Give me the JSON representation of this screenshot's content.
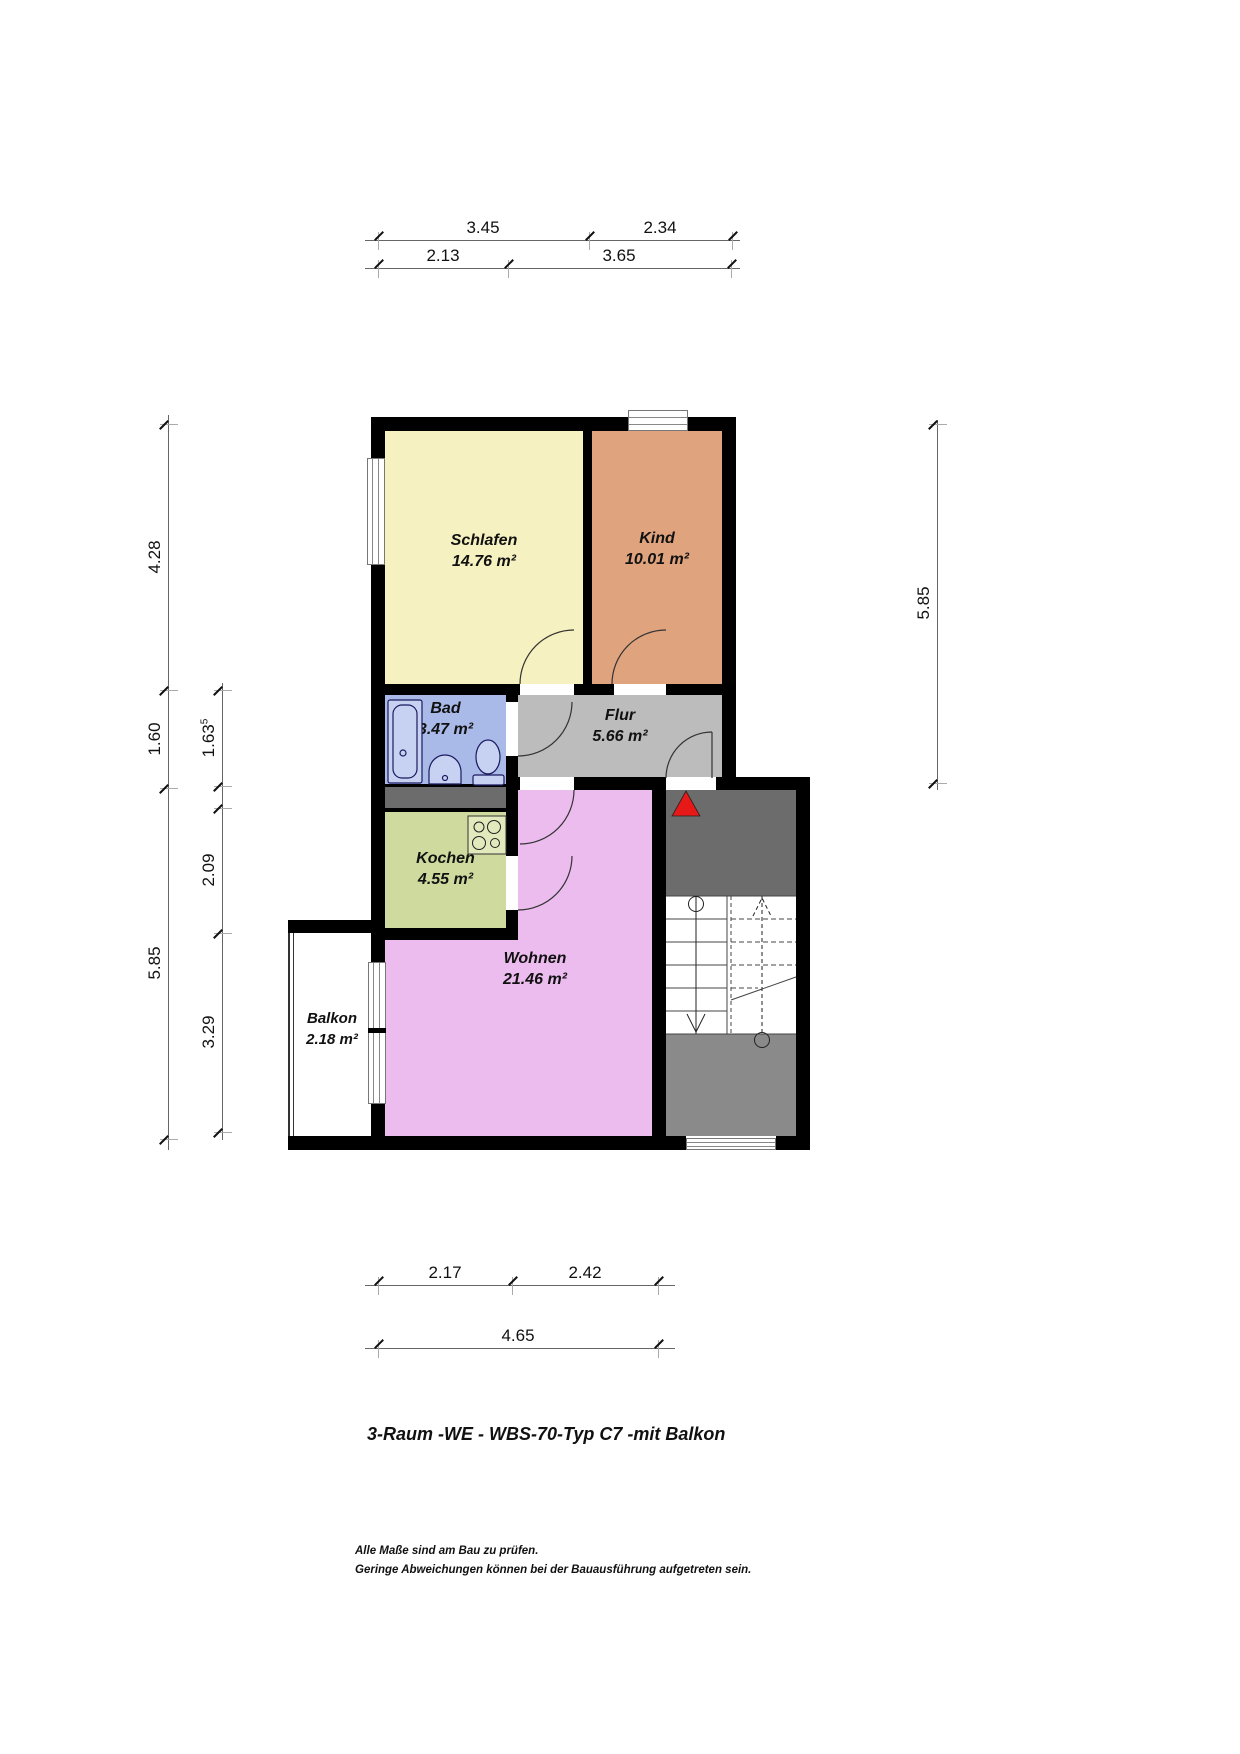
{
  "title": "3-Raum -WE - WBS-70-Typ C7 -mit Balkon",
  "notes": {
    "line1": "Alle Maße sind am Bau zu prüfen.",
    "line2": "Geringe Abweichungen können bei der Bauausführung aufgetreten sein."
  },
  "rooms": [
    {
      "name": "Schlafen",
      "area": "14.76 m²",
      "color": "#f6f1c0"
    },
    {
      "name": "Kind",
      "area": "10.01 m²",
      "color": "#dfa37e"
    },
    {
      "name": "Bad",
      "area": "3.47 m²",
      "color": "#a9b9e8"
    },
    {
      "name": "Flur",
      "area": "5.66 m²",
      "color": "#bcbcbc"
    },
    {
      "name": "Kochen",
      "area": "4.55 m²",
      "color": "#cfda9e"
    },
    {
      "name": "Wohnen",
      "area": "21.46 m²",
      "color": "#ecbcee"
    },
    {
      "name": "Balkon",
      "area": "2.18 m²",
      "color": "#ffffff"
    }
  ],
  "stairwell": {
    "landing_upper_color": "#6c6c6c",
    "landing_lower_color": "#8a8a8a",
    "entry_marker_color": "#e71818"
  },
  "dims": {
    "top1": [
      "3.45",
      "2.34"
    ],
    "top2": [
      "2.13",
      "3.65"
    ],
    "bottom1": [
      "2.17",
      "2.42"
    ],
    "bottom2": [
      "4.65"
    ],
    "left_outer": [
      "4.28",
      "1.60",
      "5.85"
    ],
    "left_inner_top": "1.63",
    "left_inner_top_sup": "5",
    "left_inner": [
      "2.09",
      "3.29"
    ],
    "right": [
      "5.85"
    ]
  }
}
